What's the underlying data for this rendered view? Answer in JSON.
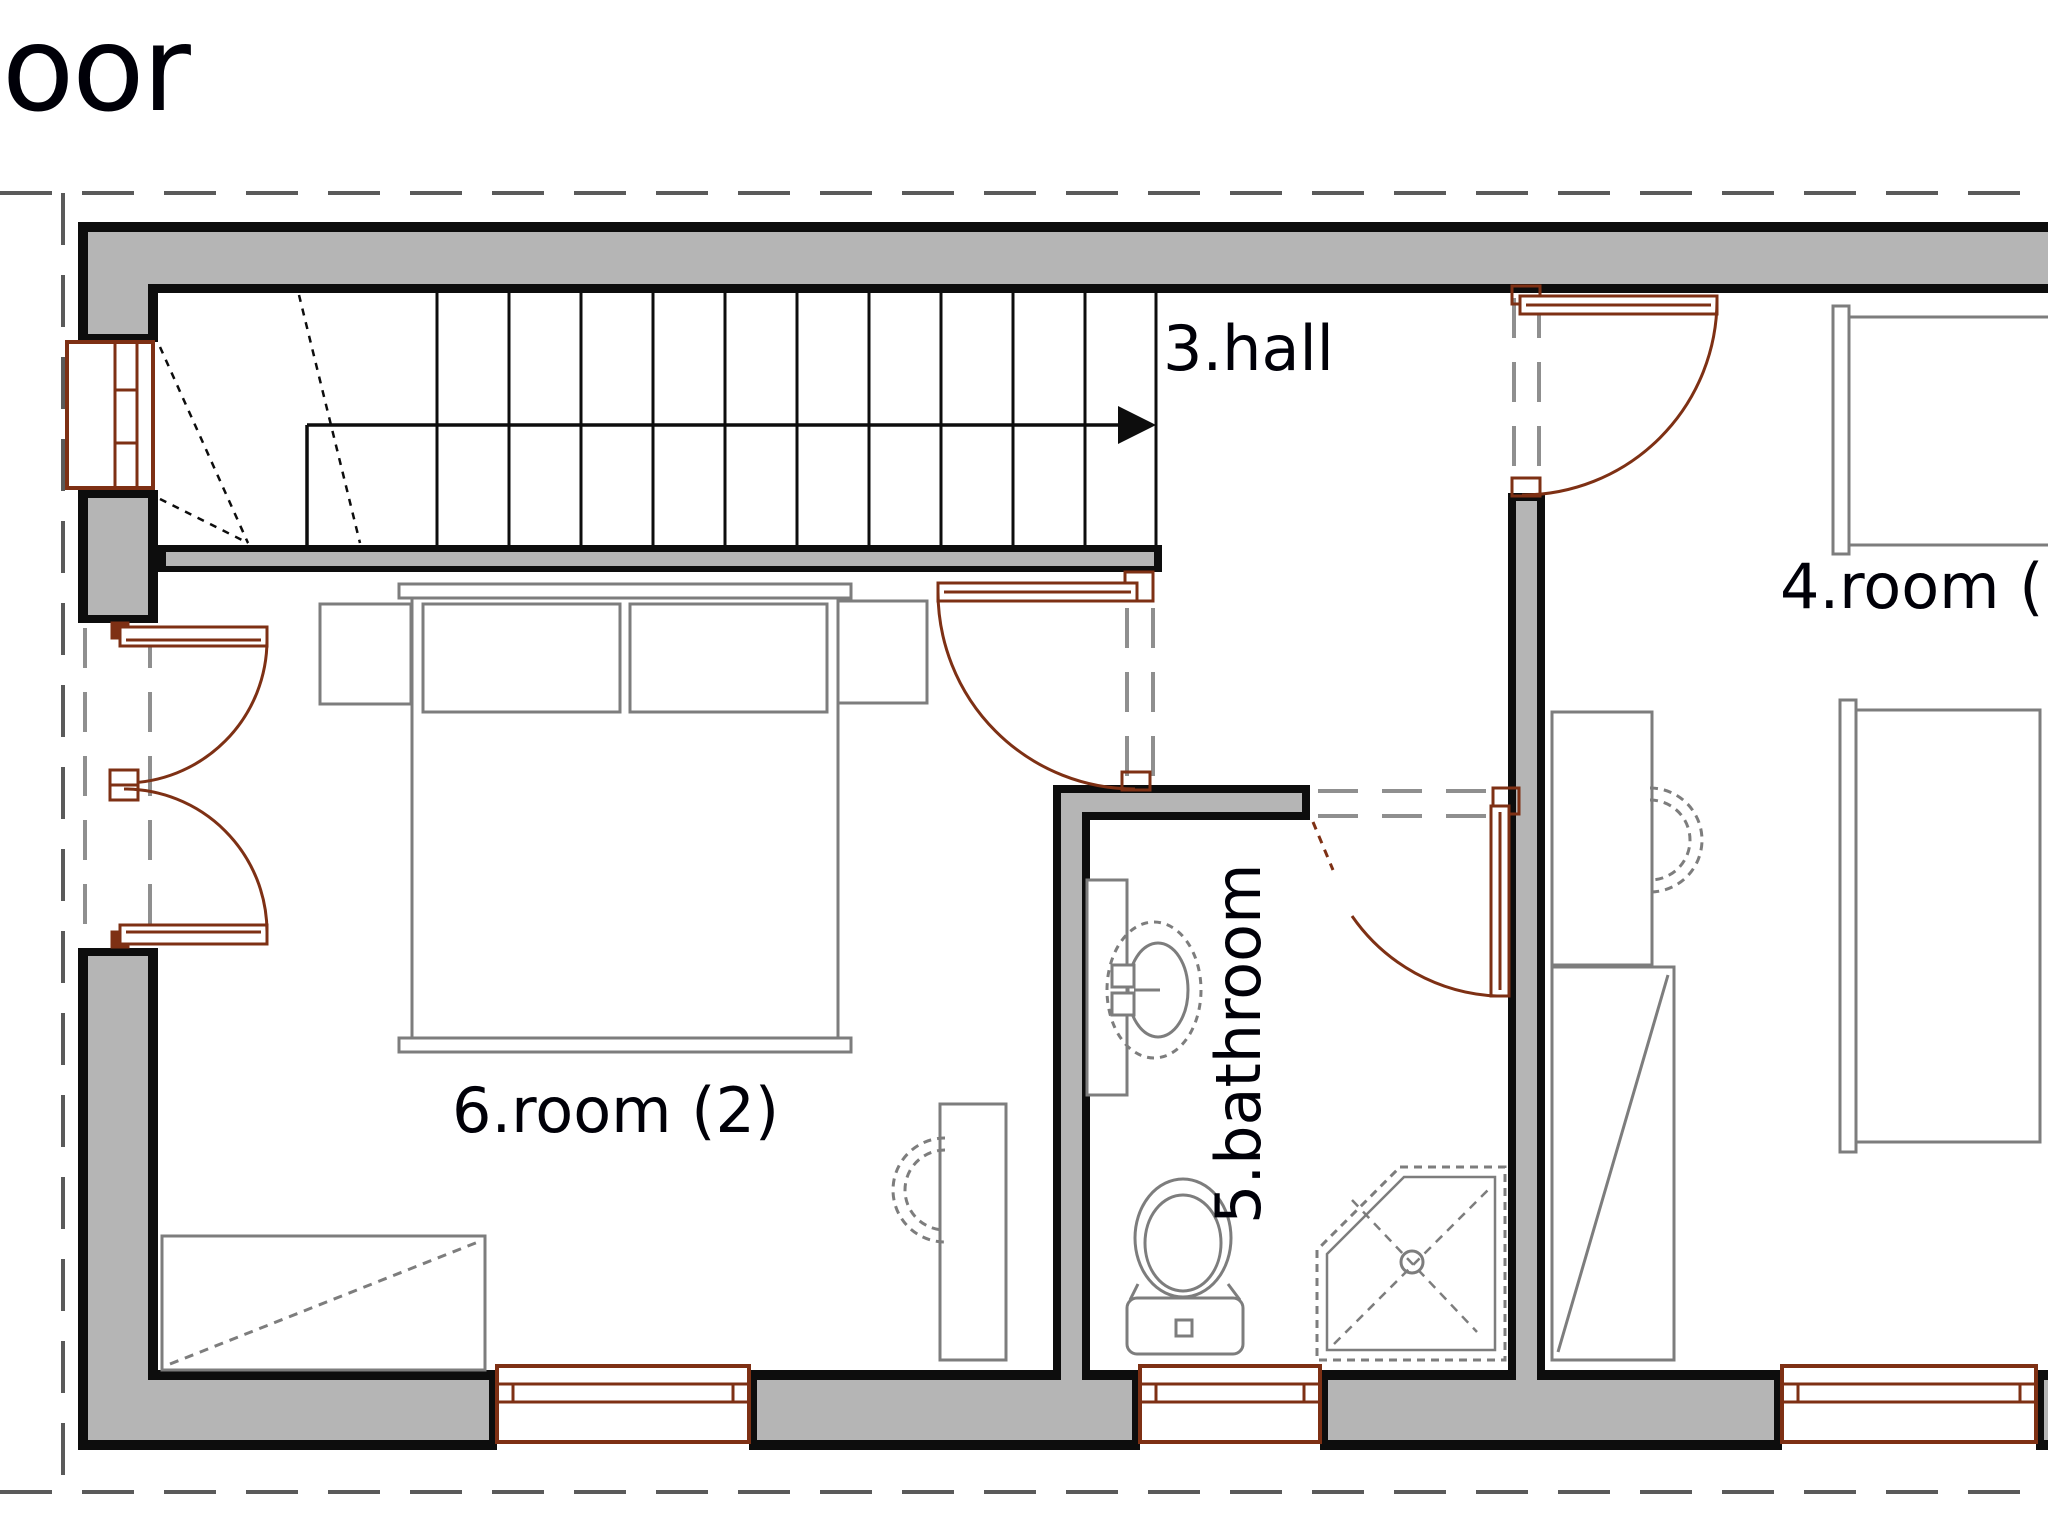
{
  "title": {
    "text": "oor"
  },
  "labels": {
    "hall": "3.hall",
    "room4": "4.room (",
    "bathroom": "5.bathroom",
    "room6": "6.room (2)"
  },
  "plan": {
    "type": "architectural-floor-plan",
    "rooms": [
      {
        "id": "3",
        "name": "hall"
      },
      {
        "id": "4",
        "name": "room"
      },
      {
        "id": "5",
        "name": "bathroom"
      },
      {
        "id": "6",
        "name": "room (2)"
      }
    ],
    "fixtures": [
      "staircase-with-winders",
      "direction-arrow",
      "double-bed",
      "pillows",
      "nightstands",
      "single-bed",
      "single-bed",
      "desk-with-chair",
      "desk-with-chair",
      "wardrobe",
      "rug",
      "washbasin-with-counter",
      "toilet",
      "corner-shower",
      "windows",
      "swing-doors"
    ]
  },
  "colors": {
    "background": "#ffffff",
    "wall_fill": "#b5b5b5",
    "wall_outline": "#0d0d0d",
    "joinery_brown": "#7e3014",
    "furniture_gray": "#7d7d7d",
    "opening_dash_gray": "#8f8f8f",
    "boundary_dash_gray": "#5a5a5a",
    "text": "#000008"
  }
}
